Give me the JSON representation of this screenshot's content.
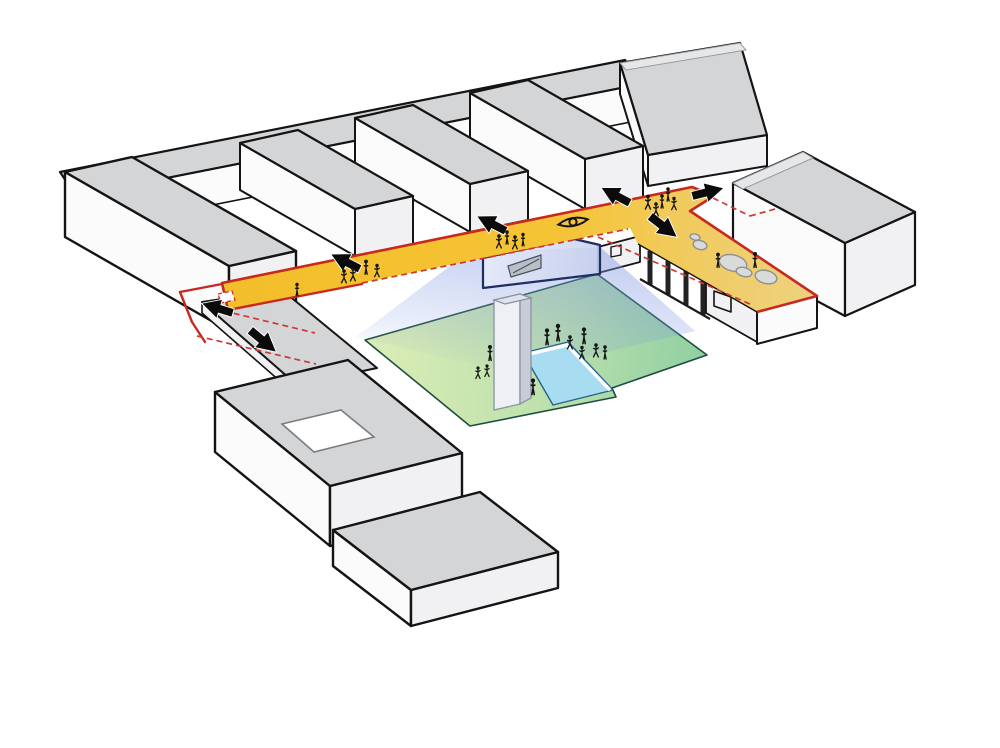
{
  "meta": {
    "app": "architectural-circulation-axonometric-diagram",
    "description": "Axonometric massing diagram: comb of grey building bars, yellow public circulation spine outlined in red, movement arrows, view eye symbol, pedestrians, sunken green courtyard with pool and tower, dashed route continuations",
    "canvas_w": 1000,
    "canvas_h": 748
  },
  "palette": {
    "path_yellow": "#F5C435",
    "terrace_yellow": "#EDD282",
    "outline_red": "#C9281E",
    "dashed_red": "#CD3A35",
    "lawn_green_light": "#DCEDB6",
    "lawn_green_dark": "#8FCFA2",
    "pool_blue": "#A8DDF1",
    "view_cone_blue": "#7E96E1",
    "glass_navy": "#1D2E63",
    "roof_grey": "#D4D5D7",
    "roof_band": "#E6E7E9",
    "face_white": "#FBFBFB",
    "face_shade": "#F1F1F3",
    "tower_light": "#EEF0F5",
    "tower_dark": "#C7CCD8",
    "planter_fill": "#D9DADA",
    "planter_stroke": "#8F9092",
    "ink": "#141414"
  },
  "icons": {
    "eye": {
      "x": 573,
      "y": 222,
      "rot": -10,
      "s": 1
    },
    "arrows": [
      {
        "x": 233,
        "y": 313,
        "rot": 197,
        "s": 1.0
      },
      {
        "x": 250,
        "y": 330,
        "rot": 40,
        "s": 1.05
      },
      {
        "x": 360,
        "y": 269,
        "rot": 207,
        "s": 1.0
      },
      {
        "x": 506,
        "y": 231,
        "rot": 207,
        "s": 1.0
      },
      {
        "x": 630,
        "y": 203,
        "rot": 208,
        "s": 1.0
      },
      {
        "x": 692,
        "y": 196,
        "rot": -14,
        "s": 1.0
      },
      {
        "x": 650,
        "y": 216,
        "rot": 38,
        "s": 1.05
      }
    ],
    "figures": [
      {
        "x": 297,
        "y": 293,
        "s": 0.85,
        "pose": "stand",
        "area": "spine"
      },
      {
        "x": 344,
        "y": 280,
        "s": 0.9,
        "pose": "walk",
        "area": "spine"
      },
      {
        "x": 353,
        "y": 278,
        "s": 0.9,
        "pose": "walk",
        "area": "spine"
      },
      {
        "x": 366,
        "y": 271,
        "s": 0.95,
        "pose": "stand",
        "area": "spine"
      },
      {
        "x": 377,
        "y": 274,
        "s": 0.85,
        "pose": "walk",
        "area": "spine"
      },
      {
        "x": 499,
        "y": 245,
        "s": 0.9,
        "pose": "walk",
        "area": "spine"
      },
      {
        "x": 507,
        "y": 241,
        "s": 0.9,
        "pose": "stand",
        "area": "spine"
      },
      {
        "x": 515,
        "y": 246,
        "s": 0.9,
        "pose": "walk",
        "area": "spine"
      },
      {
        "x": 523,
        "y": 243,
        "s": 0.85,
        "pose": "stand",
        "area": "spine"
      },
      {
        "x": 648,
        "y": 206,
        "s": 0.95,
        "pose": "walk",
        "area": "junction"
      },
      {
        "x": 656,
        "y": 213,
        "s": 0.9,
        "pose": "walk",
        "area": "junction"
      },
      {
        "x": 662,
        "y": 205,
        "s": 0.9,
        "pose": "stand",
        "area": "junction"
      },
      {
        "x": 668,
        "y": 198,
        "s": 0.9,
        "pose": "stand",
        "area": "junction"
      },
      {
        "x": 674,
        "y": 207,
        "s": 0.85,
        "pose": "walk",
        "area": "junction"
      },
      {
        "x": 718,
        "y": 264,
        "s": 0.95,
        "pose": "stand",
        "area": "terrace"
      },
      {
        "x": 755,
        "y": 264,
        "s": 1.0,
        "pose": "stand",
        "area": "terrace"
      },
      {
        "x": 490,
        "y": 357,
        "s": 1.0,
        "pose": "stand",
        "area": "courtyard"
      },
      {
        "x": 478,
        "y": 376,
        "s": 0.8,
        "pose": "walk",
        "area": "courtyard"
      },
      {
        "x": 487,
        "y": 374,
        "s": 0.8,
        "pose": "walk",
        "area": "courtyard"
      },
      {
        "x": 533,
        "y": 391,
        "s": 1.05,
        "pose": "stand",
        "area": "courtyard"
      },
      {
        "x": 547,
        "y": 341,
        "s": 1.05,
        "pose": "stand",
        "area": "courtyard"
      },
      {
        "x": 558,
        "y": 337,
        "s": 1.1,
        "pose": "stand",
        "area": "courtyard"
      },
      {
        "x": 570,
        "y": 346,
        "s": 0.9,
        "pose": "walk",
        "area": "courtyard"
      },
      {
        "x": 584,
        "y": 340,
        "s": 1.05,
        "pose": "stand",
        "area": "courtyard"
      },
      {
        "x": 582,
        "y": 356,
        "s": 0.85,
        "pose": "walk",
        "area": "courtyard"
      },
      {
        "x": 596,
        "y": 354,
        "s": 0.9,
        "pose": "walk",
        "area": "courtyard"
      },
      {
        "x": 605,
        "y": 356,
        "s": 0.9,
        "pose": "stand",
        "area": "courtyard"
      }
    ],
    "planters": [
      {
        "x": 695,
        "y": 237,
        "rx": 5,
        "ry": 3
      },
      {
        "x": 700,
        "y": 245,
        "rx": 7,
        "ry": 4.5
      },
      {
        "x": 733,
        "y": 263,
        "rx": 14,
        "ry": 8
      },
      {
        "x": 744,
        "y": 272,
        "rx": 8,
        "ry": 4.5
      },
      {
        "x": 766,
        "y": 277,
        "rx": 11,
        "ry": 6.5
      }
    ]
  },
  "annotations": {
    "dashed_lines": [
      [
        224,
        311,
        315,
        333
      ],
      [
        197,
        336,
        316,
        364
      ],
      [
        362,
        283,
        628,
        229
      ],
      [
        598,
        237,
        752,
        305
      ],
      [
        713,
        198,
        750,
        216
      ],
      [
        750,
        216,
        779,
        208
      ]
    ],
    "solid_red_lines": [
      [
        222,
        284,
        180,
        292
      ],
      [
        180,
        292,
        192,
        322
      ],
      [
        192,
        322,
        205,
        342
      ],
      [
        228,
        310,
        362,
        284
      ]
    ]
  }
}
